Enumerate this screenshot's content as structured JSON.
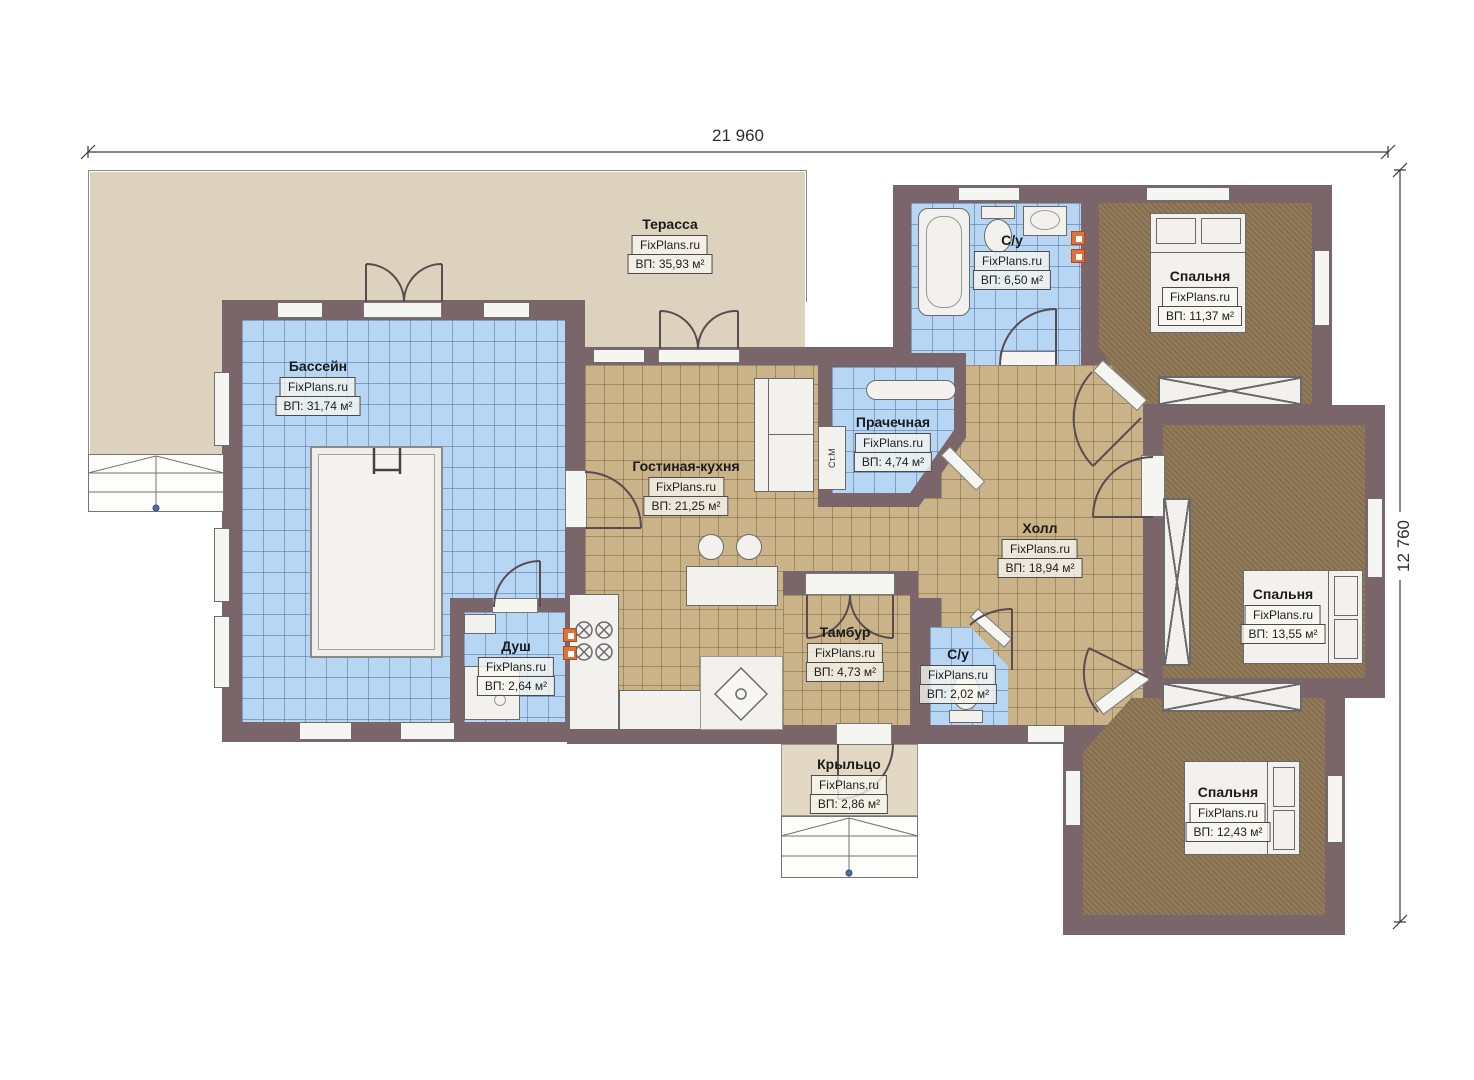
{
  "brand": "FixPlans.ru",
  "dimensions": {
    "top": "21 960",
    "right": "12 760"
  },
  "rooms": [
    {
      "name": "Терасса",
      "brand": "FixPlans.ru",
      "area": "ВП: 35,93 м²"
    },
    {
      "name": "Бассейн",
      "brand": "FixPlans.ru",
      "area": "ВП: 31,74 м²"
    },
    {
      "name": "С/у",
      "brand": "FixPlans.ru",
      "area": "ВП: 6,50 м²"
    },
    {
      "name": "Спальня",
      "brand": "FixPlans.ru",
      "area": "ВП: 11,37 м²"
    },
    {
      "name": "Прачечная",
      "brand": "FixPlans.ru",
      "area": "ВП: 4,74 м²"
    },
    {
      "name": "Гостиная-кухня",
      "brand": "FixPlans.ru",
      "area": "ВП: 21,25 м²"
    },
    {
      "name": "Холл",
      "brand": "FixPlans.ru",
      "area": "ВП: 18,94 м²"
    },
    {
      "name": "Спальня",
      "brand": "FixPlans.ru",
      "area": "ВП: 13,55 м²"
    },
    {
      "name": "Душ",
      "brand": "FixPlans.ru",
      "area": "ВП: 2,64 м²"
    },
    {
      "name": "Тамбур",
      "brand": "FixPlans.ru",
      "area": "ВП: 4,73 м²"
    },
    {
      "name": "С/у",
      "brand": "FixPlans.ru",
      "area": "ВП: 2,02 м²"
    },
    {
      "name": "Крыльцо",
      "brand": "FixPlans.ru",
      "area": "ВП: 2,86 м²"
    },
    {
      "name": "Спальня",
      "brand": "FixPlans.ru",
      "area": "ВП: 12,43 м²"
    }
  ],
  "annotations": {
    "washing_machine": "Ст.М"
  },
  "colors": {
    "wall": "#7a656a",
    "pool_tile": "#b7d6f4",
    "floor_tile": "#cab388",
    "carpet": "#8d7553",
    "terrace": "#ddd2bd",
    "accent_orange": "#e0713a"
  }
}
